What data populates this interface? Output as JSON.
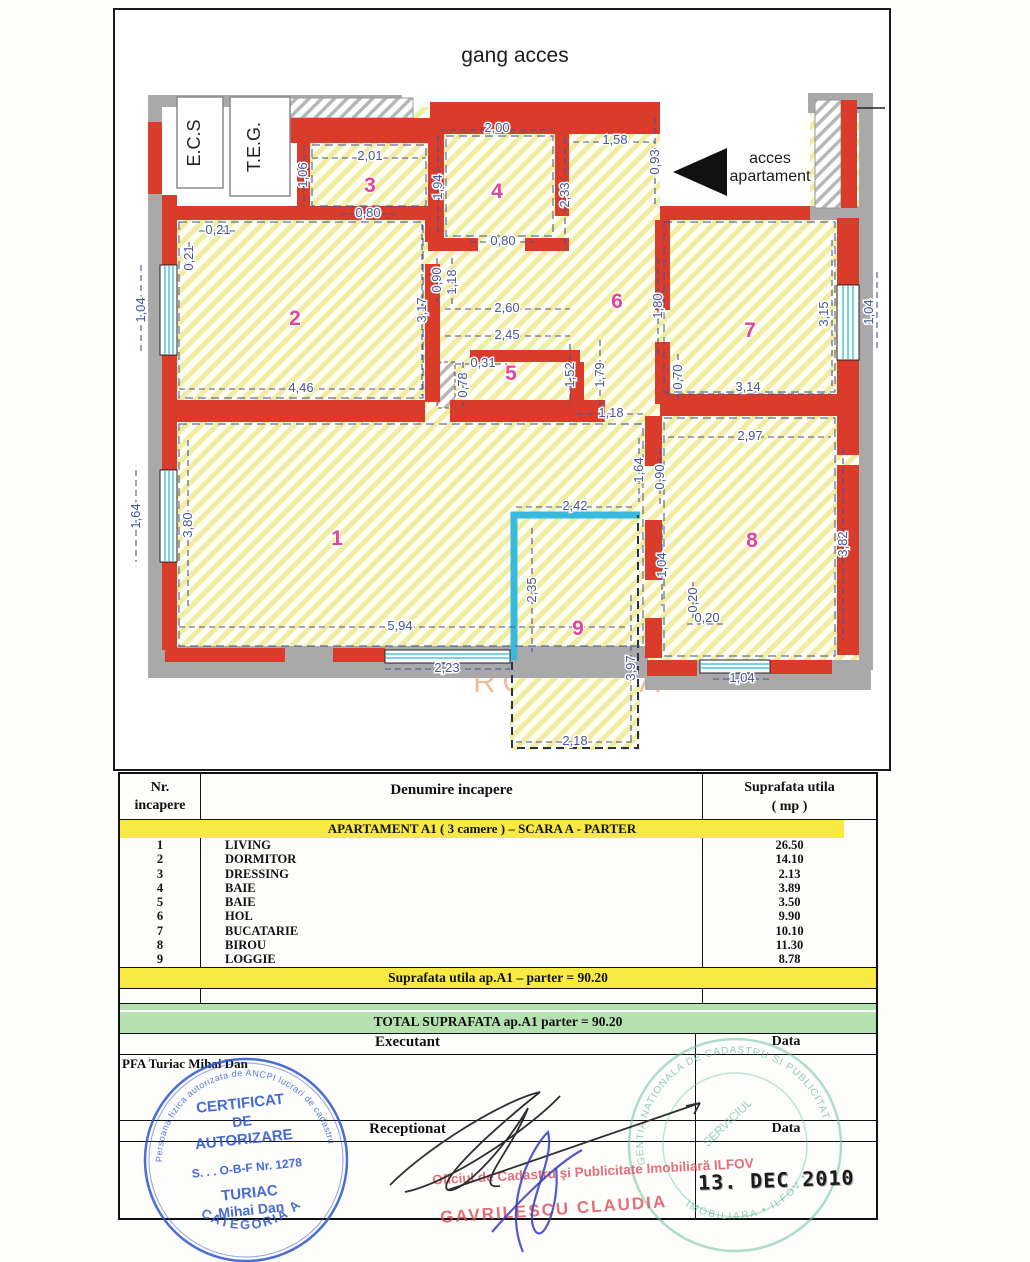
{
  "plan": {
    "title": "gang acces",
    "labels": {
      "ecs": "E.C.S",
      "teg": "T.E.G.",
      "access_line1": "acces",
      "access_line2": "apartament",
      "watermark": "ROMANIA"
    },
    "rooms": {
      "r1": "1",
      "r2": "2",
      "r3": "3",
      "r4": "4",
      "r5": "5",
      "r6": "6",
      "r7": "7",
      "r8": "8",
      "r9": "9"
    },
    "dims": {
      "d201": "2,01",
      "d200": "2,00",
      "d158": "1,58",
      "d106": "1,06",
      "d194": "1,94",
      "d233": "2,33",
      "d093": "0,93",
      "d080a": "0,80",
      "d080b": "0,80",
      "d021a": "0,21",
      "d021b": "0,21",
      "d104a": "1,04",
      "d317": "3,17",
      "d090a": "0,90",
      "d118a": "1,18",
      "d260": "2,60",
      "d245": "2,45",
      "d031": "0,31",
      "d078": "0,78",
      "d152": "1,52",
      "d179": "1,79",
      "d118b": "1,18",
      "d180": "1,80",
      "d446": "4,46",
      "d315": "3,15",
      "d104b": "1,04",
      "d314": "3,14",
      "d070": "0,70",
      "d297": "2,97",
      "d382": "3,82",
      "d164a": "1,64",
      "d090b": "0,90",
      "d104c": "1,04",
      "d020a": "0,20",
      "d020b": "0,20",
      "d104d": "1,04",
      "d380": "3,80",
      "d164b": "1,64",
      "d594": "5,94",
      "d223": "2,23",
      "d242": "2,42",
      "d235": "2,35",
      "d397": "3,97",
      "d218": "2,18"
    }
  },
  "table": {
    "headers": {
      "col1a": "Nr.",
      "col1b": "incapere",
      "col2": "Denumire incapere",
      "col3a": "Suprafata utila",
      "col3b": "( mp )"
    },
    "section_header": "APARTAMENT A1 ( 3 camere ) – SCARA A - PARTER",
    "rows": [
      {
        "nr": "1",
        "name": "LIVING",
        "area": "26.50"
      },
      {
        "nr": "2",
        "name": "DORMITOR",
        "area": "14.10"
      },
      {
        "nr": "3",
        "name": "DRESSING",
        "area": "2.13"
      },
      {
        "nr": "4",
        "name": "BAIE",
        "area": "3.89"
      },
      {
        "nr": "5",
        "name": "BAIE",
        "area": "3.50"
      },
      {
        "nr": "6",
        "name": "HOL",
        "area": "9.90"
      },
      {
        "nr": "7",
        "name": "BUCATARIE",
        "area": "10.10"
      },
      {
        "nr": "8",
        "name": "BIROU",
        "area": "11.30"
      },
      {
        "nr": "9",
        "name": "LOGGIE",
        "area": "8.78"
      }
    ],
    "subtotal": "Suprafata utila ap.A1 – parter = 90.20",
    "total": "TOTAL SUPRAFATA ap.A1 parter = 90.20",
    "executant_label": "Executant",
    "receptionat_label": "Receptionat",
    "data_label1": "Data",
    "data_label2": "Data",
    "executant_name": "PFA Turiac Mihai Dan"
  },
  "stamps": {
    "blue": {
      "line1": "CERTIFICAT",
      "line2": "DE",
      "line3": "AUTORIZARE",
      "line4": "S. . . O-B-F Nr. 1278",
      "line5": "TURIAC",
      "line6": "Mihai Dan",
      "arc_top": "Persoana fizica autorizata de ANCPI lucrari de cadastru",
      "arc_bottom": "CATEGORIA A"
    },
    "red": {
      "line1": "Oficiul de Cadastru şi Publicitate Imobiliară ILFOV",
      "line2": "GAVRILESCU CLAUDIA"
    },
    "date_stamp": "13. DEC 2010",
    "green": {
      "arc_top": "AGENTIA NATIONALA DE CADASTRU SI PUBLICITATE",
      "arc_bottom": "IMOBILIARA • ILFOV •",
      "center": "SERVICIUL"
    }
  }
}
